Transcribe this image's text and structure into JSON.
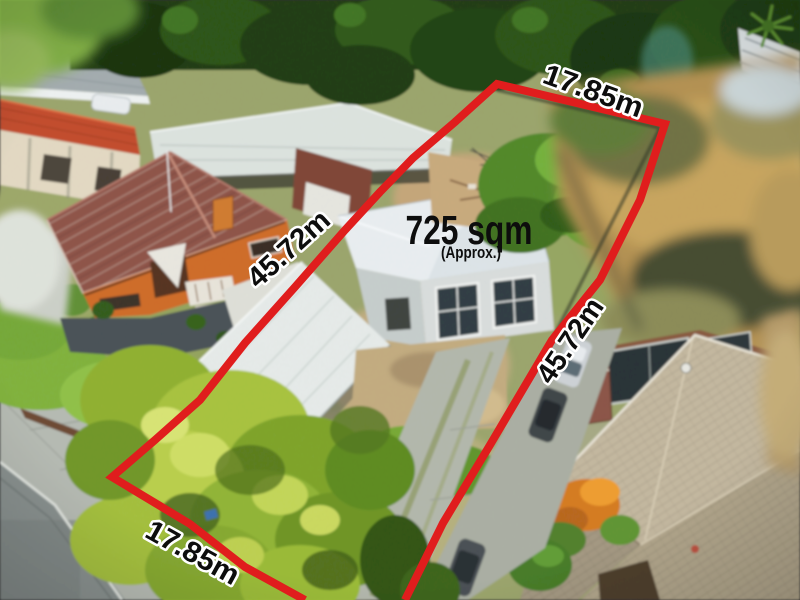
{
  "annotations": {
    "boundary_color": "#e01d1d",
    "label_color": "#0d0d0d",
    "label_outline_color": "#ffffff",
    "area": {
      "value": "725 sqm",
      "qualifier": "(Approx.)"
    },
    "dimensions": [
      {
        "side": "top",
        "label": "17.85m"
      },
      {
        "side": "left",
        "label": "45.72m"
      },
      {
        "side": "right",
        "label": "45.72m"
      },
      {
        "side": "bottom",
        "label": "17.85m"
      }
    ]
  }
}
